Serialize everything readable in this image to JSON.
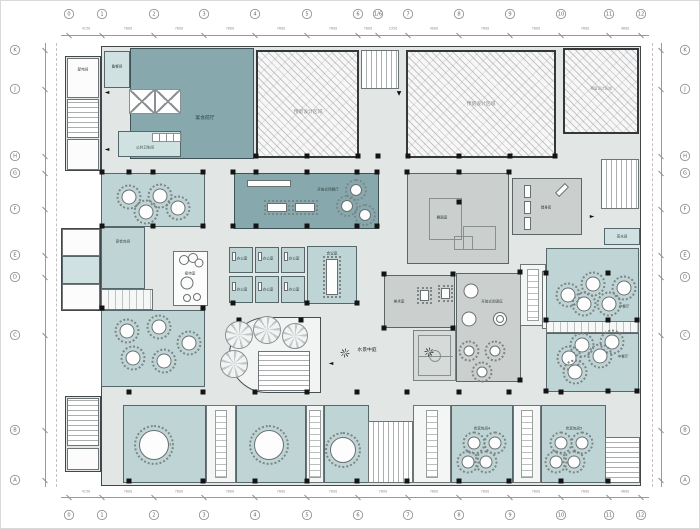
{
  "drawing": {
    "type": "architectural-floor-plan",
    "colors": {
      "floor": "#e2e6e5",
      "dining_teal": "#bfd5d5",
      "hall_dark_teal": "#87a9ad",
      "activity_gray": "#cbcfce",
      "hatch_reserved": "#f7f7f7",
      "wall": "#42484a",
      "column": "#141414"
    }
  },
  "rooms": {
    "prep": {
      "label": "备餐间"
    },
    "power": {
      "label": "配电间"
    },
    "foyer": {
      "label": "宴会前厅"
    },
    "toilet": {
      "label": "公共卫生间"
    },
    "reserved": {
      "label": "预留设计区域"
    },
    "open_rest": {
      "label": "开放式西餐厅"
    },
    "office": {
      "label": "办公室"
    },
    "meeting": {
      "label": "会议室"
    },
    "dance": {
      "label": "舞蹈室"
    },
    "gym": {
      "label": "健身房"
    },
    "tea": {
      "label": "茶水间"
    },
    "art": {
      "label": "美术室"
    },
    "reading": {
      "label": "开放式阅读区"
    },
    "reception": {
      "label": "接待室"
    },
    "banquet_left": {
      "label": "宴会包间"
    },
    "atrium": {
      "label": "水景中庭"
    },
    "dining_r1": {
      "label": "中餐厅"
    },
    "dining_r2": {
      "label": "中餐厅"
    },
    "b1": {
      "label": "宴会包间1"
    },
    "b2": {
      "label": "宴会包间2"
    },
    "b3": {
      "label": "宴会包间3"
    },
    "b5": {
      "label": "贵宾包间4"
    },
    "b6": {
      "label": "贵宾包间5"
    }
  },
  "axes": {
    "bottom": {
      "labels": [
        "0",
        "1",
        "2",
        "3",
        "4",
        "5",
        "6",
        "7",
        "8",
        "9",
        "10",
        "11",
        "12"
      ],
      "x": [
        68,
        101,
        153,
        203,
        254,
        306,
        357,
        407,
        458,
        509,
        560,
        608,
        640
      ]
    },
    "top": {
      "labels": [
        "0",
        "1",
        "2",
        "3",
        "4",
        "5",
        "6",
        "1/6",
        "7",
        "8",
        "9",
        "10",
        "11",
        "12"
      ],
      "x": [
        68,
        101,
        153,
        203,
        254,
        306,
        357,
        377,
        407,
        458,
        509,
        560,
        608,
        640
      ]
    },
    "left": {
      "labels": [
        "K",
        "J",
        "H",
        "G",
        "F",
        "E",
        "D",
        "C",
        "B",
        "A"
      ],
      "y": [
        49,
        88,
        155,
        172,
        208,
        254,
        276,
        334,
        429,
        479
      ]
    },
    "right": {
      "labels": [
        "K",
        "J",
        "H",
        "G",
        "F",
        "E",
        "D",
        "C",
        "B",
        "A"
      ],
      "y": [
        49,
        88,
        155,
        172,
        208,
        254,
        276,
        334,
        429,
        479
      ]
    }
  },
  "dims": {
    "bottom": [
      "4150",
      "7800",
      "7800",
      "7800",
      "7800",
      "7800",
      "7800",
      "7800",
      "7800",
      "7800",
      "7800",
      "4800"
    ],
    "top": [
      "4150",
      "7800",
      "7800",
      "7800",
      "7800",
      "7800",
      "7800",
      "2350",
      "4000",
      "7800",
      "7800",
      "7800",
      "4800"
    ]
  },
  "plan": {
    "columns": [
      [
        255,
        155
      ],
      [
        306,
        155
      ],
      [
        357,
        155
      ],
      [
        377,
        155
      ],
      [
        407,
        155
      ],
      [
        458,
        155
      ],
      [
        509,
        155
      ],
      [
        554,
        155
      ],
      [
        101,
        171
      ],
      [
        128,
        171
      ],
      [
        152,
        171
      ],
      [
        202,
        171
      ],
      [
        232,
        171
      ],
      [
        255,
        171
      ],
      [
        306,
        171
      ],
      [
        356,
        171
      ],
      [
        376,
        171
      ],
      [
        406,
        171
      ],
      [
        458,
        171
      ],
      [
        508,
        171
      ],
      [
        101,
        225
      ],
      [
        152,
        225
      ],
      [
        202,
        225
      ],
      [
        232,
        225
      ],
      [
        255,
        225
      ],
      [
        306,
        225
      ],
      [
        356,
        225
      ],
      [
        376,
        225
      ],
      [
        101,
        307
      ],
      [
        202,
        307
      ],
      [
        232,
        302
      ],
      [
        306,
        302
      ],
      [
        356,
        302
      ],
      [
        383,
        273
      ],
      [
        452,
        273
      ],
      [
        383,
        327
      ],
      [
        452,
        327
      ],
      [
        519,
        271
      ],
      [
        519,
        379
      ],
      [
        458,
        201
      ],
      [
        545,
        272
      ],
      [
        607,
        272
      ],
      [
        545,
        319
      ],
      [
        607,
        319
      ],
      [
        636,
        319
      ],
      [
        545,
        390
      ],
      [
        607,
        390
      ],
      [
        636,
        390
      ],
      [
        238,
        319
      ],
      [
        300,
        319
      ],
      [
        128,
        391
      ],
      [
        202,
        391
      ],
      [
        254,
        391
      ],
      [
        306,
        391
      ],
      [
        356,
        391
      ],
      [
        406,
        391
      ],
      [
        458,
        391
      ],
      [
        508,
        391
      ],
      [
        560,
        391
      ],
      [
        128,
        480
      ],
      [
        202,
        480
      ],
      [
        254,
        480
      ],
      [
        306,
        480
      ],
      [
        356,
        480
      ],
      [
        406,
        480
      ],
      [
        458,
        480
      ],
      [
        508,
        480
      ],
      [
        560,
        480
      ],
      [
        607,
        480
      ]
    ],
    "round_tables": [
      {
        "x": 153,
        "y": 444,
        "d": 28
      },
      {
        "x": 268,
        "y": 444,
        "d": 28
      },
      {
        "x": 342,
        "y": 449,
        "d": 24
      },
      {
        "x": 128,
        "y": 196,
        "d": 13
      },
      {
        "x": 159,
        "y": 195,
        "d": 13
      },
      {
        "x": 145,
        "y": 211,
        "d": 13
      },
      {
        "x": 177,
        "y": 207,
        "d": 13
      },
      {
        "x": 126,
        "y": 330,
        "d": 13
      },
      {
        "x": 158,
        "y": 326,
        "d": 13
      },
      {
        "x": 132,
        "y": 357,
        "d": 13
      },
      {
        "x": 163,
        "y": 360,
        "d": 13
      },
      {
        "x": 188,
        "y": 342,
        "d": 13
      },
      {
        "x": 592,
        "y": 283,
        "d": 13
      },
      {
        "x": 623,
        "y": 287,
        "d": 13
      },
      {
        "x": 583,
        "y": 303,
        "d": 13
      },
      {
        "x": 608,
        "y": 303,
        "d": 13
      },
      {
        "x": 567,
        "y": 294,
        "d": 13
      },
      {
        "x": 581,
        "y": 344,
        "d": 13
      },
      {
        "x": 611,
        "y": 341,
        "d": 13
      },
      {
        "x": 568,
        "y": 357,
        "d": 13
      },
      {
        "x": 599,
        "y": 355,
        "d": 13
      },
      {
        "x": 574,
        "y": 371,
        "d": 13
      },
      {
        "x": 355,
        "y": 189,
        "d": 10
      },
      {
        "x": 346,
        "y": 205,
        "d": 10
      },
      {
        "x": 364,
        "y": 214,
        "d": 10
      },
      {
        "x": 468,
        "y": 350,
        "d": 9
      },
      {
        "x": 494,
        "y": 350,
        "d": 9
      },
      {
        "x": 481,
        "y": 371,
        "d": 9
      },
      {
        "x": 473,
        "y": 442,
        "d": 11
      },
      {
        "x": 494,
        "y": 442,
        "d": 11
      },
      {
        "x": 467,
        "y": 461,
        "d": 11
      },
      {
        "x": 485,
        "y": 461,
        "d": 11
      },
      {
        "x": 560,
        "y": 442,
        "d": 11
      },
      {
        "x": 581,
        "y": 442,
        "d": 11
      },
      {
        "x": 555,
        "y": 461,
        "d": 11
      },
      {
        "x": 573,
        "y": 461,
        "d": 11
      }
    ],
    "circles": [
      {
        "x": 470,
        "y": 290,
        "d": 13
      },
      {
        "x": 468,
        "y": 318,
        "d": 13
      },
      {
        "x": 499,
        "y": 318,
        "d": 12
      },
      {
        "x": 499,
        "y": 318,
        "d": 6
      },
      {
        "x": 186,
        "y": 282,
        "d": 11
      },
      {
        "x": 183,
        "y": 259,
        "d": 8
      },
      {
        "x": 192,
        "y": 257,
        "d": 8
      },
      {
        "x": 198,
        "y": 262,
        "d": 7
      },
      {
        "x": 186,
        "y": 297,
        "d": 6
      },
      {
        "x": 196,
        "y": 296,
        "d": 6
      }
    ],
    "rect_tables": [
      {
        "x": 266,
        "y": 202,
        "w": 20,
        "h": 9,
        "ring": 1
      },
      {
        "x": 294,
        "y": 202,
        "w": 20,
        "h": 9,
        "ring": 1
      },
      {
        "x": 325,
        "y": 258,
        "w": 12,
        "h": 36,
        "ring": 1
      },
      {
        "x": 419,
        "y": 289,
        "w": 9,
        "h": 11,
        "ring": 1
      },
      {
        "x": 440,
        "y": 287,
        "w": 9,
        "h": 11,
        "ring": 1
      },
      {
        "x": 231,
        "y": 251,
        "w": 4,
        "h": 9
      },
      {
        "x": 257,
        "y": 251,
        "w": 4,
        "h": 9
      },
      {
        "x": 283,
        "y": 251,
        "w": 4,
        "h": 9
      },
      {
        "x": 231,
        "y": 281,
        "w": 4,
        "h": 9
      },
      {
        "x": 257,
        "y": 281,
        "w": 4,
        "h": 9
      },
      {
        "x": 283,
        "y": 281,
        "w": 4,
        "h": 9
      },
      {
        "x": 523,
        "y": 184,
        "w": 7,
        "h": 13
      },
      {
        "x": 523,
        "y": 200,
        "w": 7,
        "h": 13
      },
      {
        "x": 523,
        "y": 216,
        "w": 7,
        "h": 13
      },
      {
        "x": 558,
        "y": 182,
        "w": 6,
        "h": 14,
        "rot": 45
      },
      {
        "x": 246,
        "y": 179,
        "w": 44,
        "h": 7
      }
    ],
    "fans": [
      {
        "x": 238,
        "y": 334,
        "d": 26
      },
      {
        "x": 266,
        "y": 329,
        "d": 26
      },
      {
        "x": 294,
        "y": 335,
        "d": 24
      },
      {
        "x": 233,
        "y": 363,
        "d": 26
      }
    ],
    "arrows": [
      {
        "x": 106,
        "y": 92,
        "g": "◄"
      },
      {
        "x": 106,
        "y": 149,
        "g": "◄"
      },
      {
        "x": 398,
        "y": 93,
        "g": "▼"
      },
      {
        "x": 591,
        "y": 216,
        "g": "►"
      },
      {
        "x": 330,
        "y": 363,
        "g": "◄"
      }
    ],
    "plants": [
      {
        "x": 344,
        "y": 352
      },
      {
        "x": 428,
        "y": 351
      }
    ]
  }
}
